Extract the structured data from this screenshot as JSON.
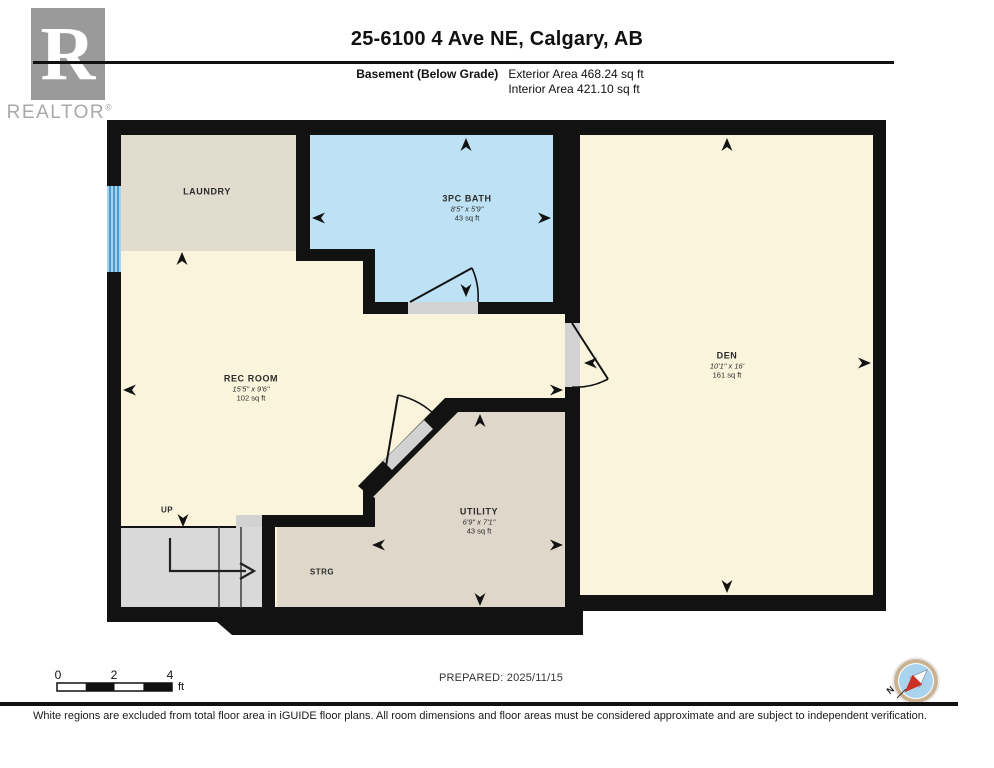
{
  "header": {
    "title": "25-6100 4 Ave NE, Calgary, AB",
    "floor_label": "Basement (Below Grade)",
    "exterior_area": "Exterior Area 468.24 sq ft",
    "interior_area": "Interior Area 421.10 sq ft"
  },
  "logo": {
    "letter": "R",
    "brand": "REALTOR",
    "registered": "®"
  },
  "rooms": {
    "laundry": {
      "name": "LAUNDRY"
    },
    "bath": {
      "name": "3PC BATH",
      "dims": "8'5\" x 5'9\"",
      "area": "43 sq ft"
    },
    "rec": {
      "name": "REC ROOM",
      "dims": "15'5\" x 9'6\"",
      "area": "102 sq ft"
    },
    "den": {
      "name": "DEN",
      "dims": "10'1\" x 16'",
      "area": "161 sq ft"
    },
    "utility": {
      "name": "UTILITY",
      "dims": "6'9\" x 7'1\"",
      "area": "43 sq ft"
    },
    "storage": {
      "name": "STRG"
    },
    "stairs": {
      "label": "UP"
    }
  },
  "scale_bar": {
    "tick0": "0",
    "tick2": "2",
    "tick4": "4",
    "unit": "ft"
  },
  "prepared": "PREPARED: 2025/11/15",
  "compass": {
    "north": "N"
  },
  "footer": "White regions are excluded from total floor area in iGUIDE floor plans. All room dimensions and floor areas must be considered approximate and are subject to independent verification.",
  "colors": {
    "wall": "#121212",
    "room_cream": "#FAF4DC",
    "room_tan": "#E2DCCF",
    "room_tan_dark": "#DFD8CA",
    "bath_blue": "#BEE2F5",
    "stairs_gray": "#D9D9D9",
    "door_gray": "#D2D2D2",
    "window_blue": "#4A9BD1",
    "compass_red": "#CC2F23",
    "compass_ring": "#C9B393",
    "compass_face": "#AAD4EE"
  }
}
